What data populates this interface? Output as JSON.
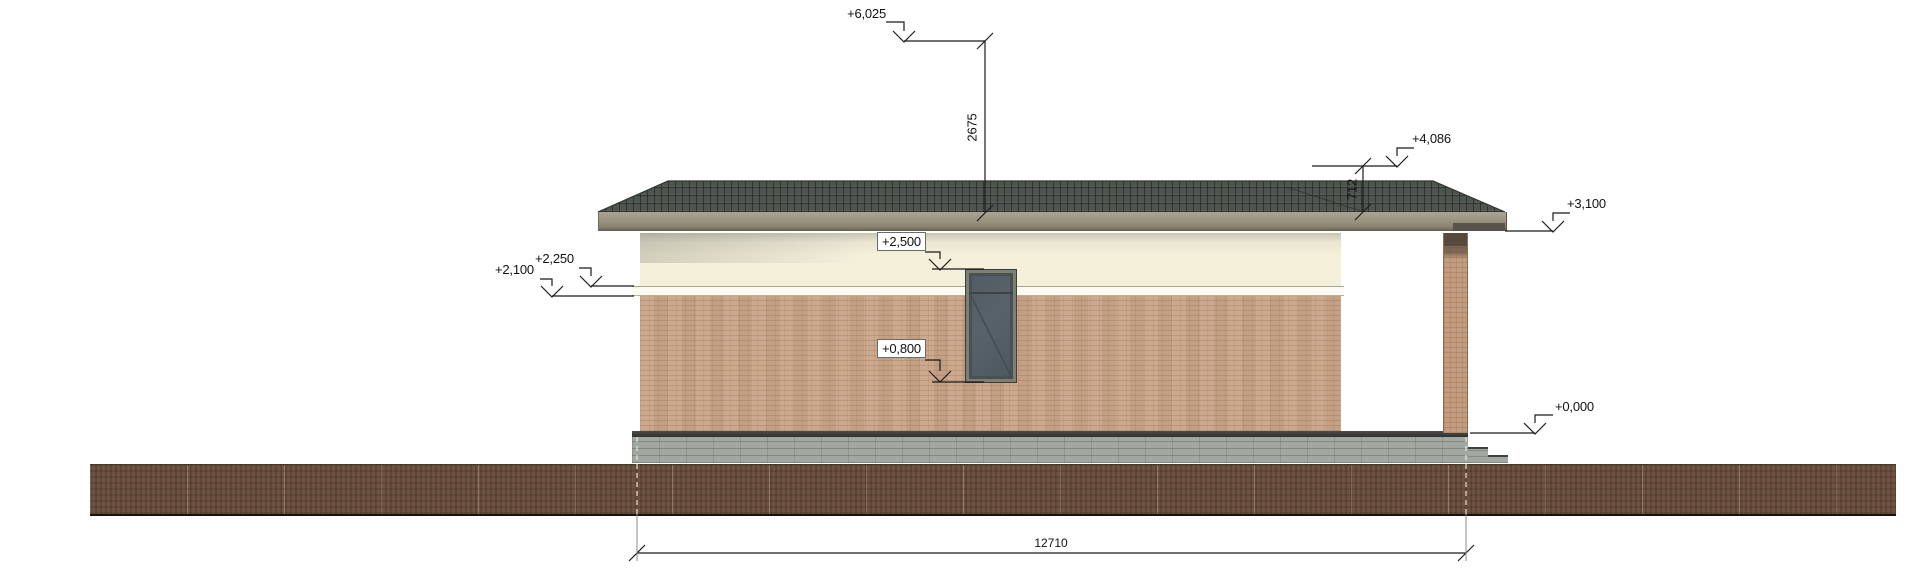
{
  "drawing": {
    "kind": "house side elevation",
    "levels": {
      "peak": "+6,025",
      "roof_right": "+4,086",
      "eave": "+3,100",
      "window_head": "+2,500",
      "cornice_top": "+2,250",
      "cornice_bottom": "+2,100",
      "window_sill": "+0,800",
      "zero": "+0,000"
    },
    "dimensions": {
      "peak_to_eave": "2675",
      "roof_rise_right": "712",
      "overall_length": "12710"
    },
    "colors": {
      "roof_tiles": "#4e544e",
      "fascia": "#968f7c",
      "upper_wall": "#f4f0da",
      "cornice": "#fbfaf3",
      "brick_wall": "#c9a488",
      "plinth": "#a0a8a1",
      "ground": "#6f5340",
      "column_brick": "#c29c7e",
      "window_glass": "#58626b"
    }
  }
}
